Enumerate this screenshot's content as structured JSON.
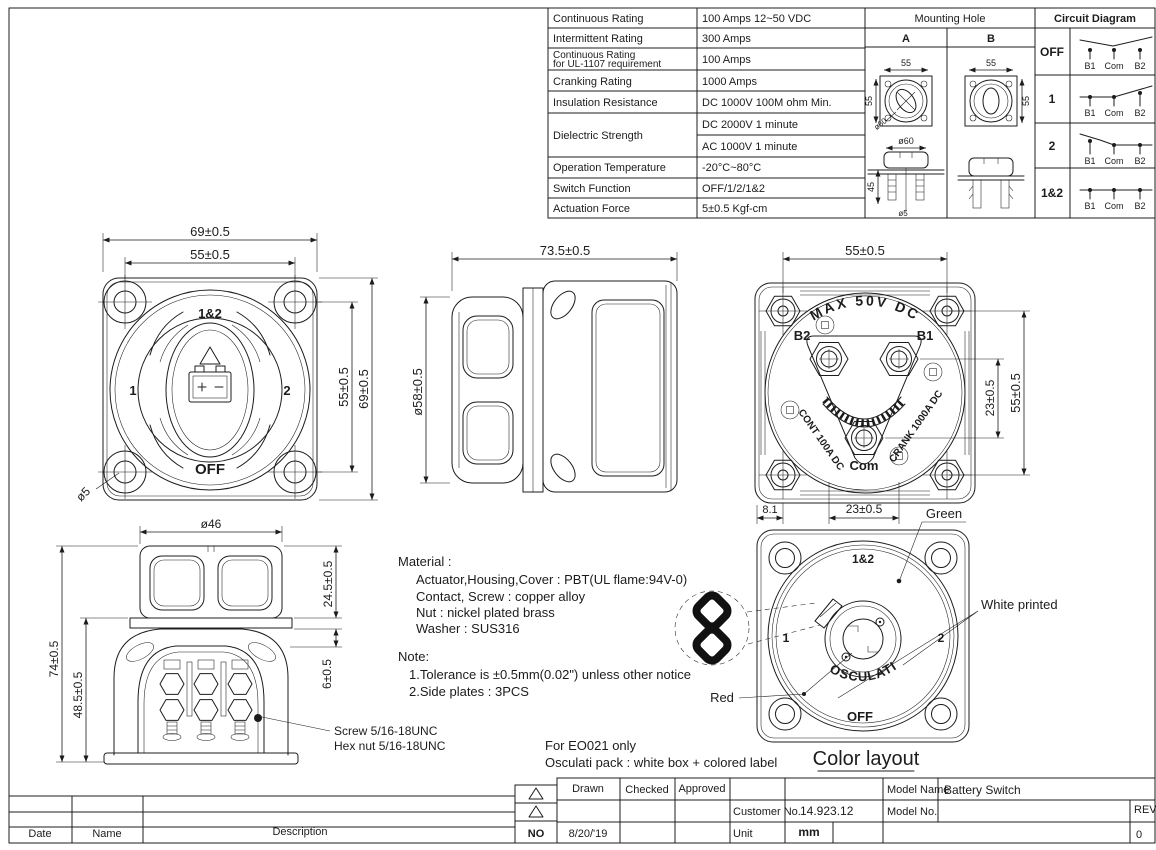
{
  "spec_table": {
    "rows": [
      {
        "label": "Continuous Rating",
        "value": "100 Amps 12~50 VDC"
      },
      {
        "label": "Intermittent Rating",
        "value": "300 Amps"
      },
      {
        "label": "Continuous Rating",
        "label2": "for UL-1107 requirement",
        "value": "100 Amps"
      },
      {
        "label": "Cranking Rating",
        "value": "1000 Amps"
      },
      {
        "label": "Insulation Resistance",
        "value": "DC 1000V 100M ohm Min."
      },
      {
        "label": "Dielectric Strength",
        "value": "DC 2000V 1 minute",
        "value2": "AC 1000V 1 minute"
      },
      {
        "label": "Operation Temperature",
        "value": "-20°C~80°C"
      },
      {
        "label": "Switch Function",
        "value": "OFF/1/2/1&2"
      },
      {
        "label": "Actuation Force",
        "value": "5±0.5 Kgf-cm"
      }
    ]
  },
  "mounting_hole": {
    "title": "Mounting Hole",
    "col_a": "A",
    "col_b": "B",
    "a_top": "55",
    "a_left": "55",
    "a_dia": "ø60",
    "a_side_dia": "ø60",
    "a_side_depth": "45",
    "a_side_screw": "ø5",
    "b_top": "55",
    "b_right": "55"
  },
  "circuit": {
    "title": "Circuit Diagram",
    "states": [
      "OFF",
      "1",
      "2",
      "1&2"
    ],
    "t1": "B1",
    "t2": "Com",
    "t3": "B2"
  },
  "front_view": {
    "dim_width": "69±0.5",
    "dim_holes": "55±0.5",
    "dim_holes_v": "55±0.5",
    "dim_height": "69±0.5",
    "dim_hole_dia": "ø5",
    "label_12": "1&2",
    "label_1": "1",
    "label_2": "2",
    "label_off": "OFF"
  },
  "side_view": {
    "dim_length": "73.5±0.5",
    "dim_knob": "ø58±0.5"
  },
  "back_view": {
    "dim_holes": "55±0.5",
    "dim_stud_v": "23±0.5",
    "dim_holes_v": "55±0.5",
    "dim_edge": "8.1",
    "dim_studs": "23±0.5",
    "label_max": "MAX 50V DC",
    "label_b2": "B2",
    "label_b1": "B1",
    "label_com": "Com",
    "label_cont": "CONT 100A DC",
    "label_crank": "CRANK 1000A DC"
  },
  "bottom_view": {
    "dim_knob": "ø46",
    "dim_knob_h": "24.5±0.5",
    "dim_flange": "6±0.5",
    "dim_total": "74±0.5",
    "dim_body": "48.5±0.5",
    "callout1": "Screw 5/16-18UNC",
    "callout2": "Hex nut  5/16-18UNC"
  },
  "material": {
    "title": "Material :",
    "l1": "Actuator,Housing,Cover : PBT(UL flame:94V-0)",
    "l2": "Contact, Screw : copper alloy",
    "l3": "Nut : nickel plated brass",
    "l4": "Washer : SUS316"
  },
  "note": {
    "title": "Note:",
    "l1": "1.Tolerance is ±0.5mm(0.02\") unless other notice",
    "l2": "2.Side plates : 3PCS"
  },
  "packing": {
    "l1": "For EO021 only",
    "l2": "Osculati pack :  white box + colored label"
  },
  "color_layout": {
    "caption": "Color layout",
    "label_12": "1&2",
    "label_1": "1",
    "label_2": "2",
    "label_off": "OFF",
    "brand": "OSCULATI",
    "green": "Green",
    "white": "White printed",
    "red": "Red"
  },
  "title_block": {
    "date": "Date",
    "name": "Name",
    "description": "Description",
    "no": "NO",
    "drawn": "Drawn",
    "checked": "Checked",
    "approved": "Approved",
    "drawn_date": "8/20/'19",
    "customer_label": "Customer No.",
    "customer_value": "14.923.12",
    "unit_label": "Unit",
    "unit_value": "mm",
    "model_name_label": "Model Name",
    "model_name_value": "Battery Switch",
    "model_no_label": "Model No.",
    "rev_label": "REV",
    "rev_value": "0"
  }
}
